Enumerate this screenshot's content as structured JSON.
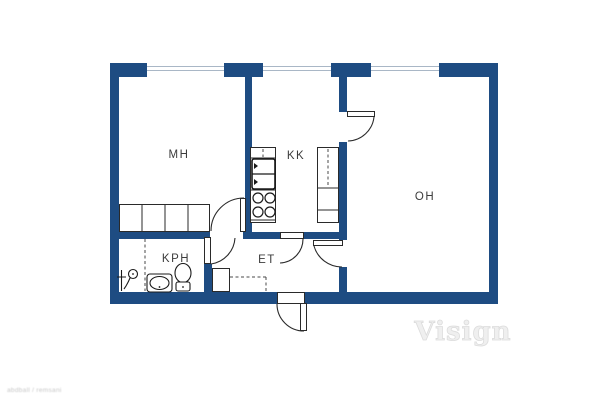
{
  "title": "apartment-floor-plan",
  "colors": {
    "wall": "#1e4c82",
    "outline": "#2a2a2a",
    "window_pane_line": "#a9b7c6",
    "label_text": "#3c3c3c",
    "watermark": "#efefef",
    "background": "#ffffff"
  },
  "rooms": [
    {
      "id": "mh",
      "label": "MH"
    },
    {
      "id": "kk",
      "label": "KK"
    },
    {
      "id": "oh",
      "label": "OH"
    },
    {
      "id": "kph",
      "label": "KPH"
    },
    {
      "id": "et",
      "label": "ET"
    }
  ],
  "icons": [
    "shower-icon",
    "sink-icon",
    "toilet-icon",
    "stove-burners-icon",
    "refrigerator-icon",
    "wardrobe-icon",
    "closet-icon",
    "door-swing-arc"
  ],
  "watermark": {
    "brand": "Visign",
    "fine_print": "abdball / remsani"
  }
}
